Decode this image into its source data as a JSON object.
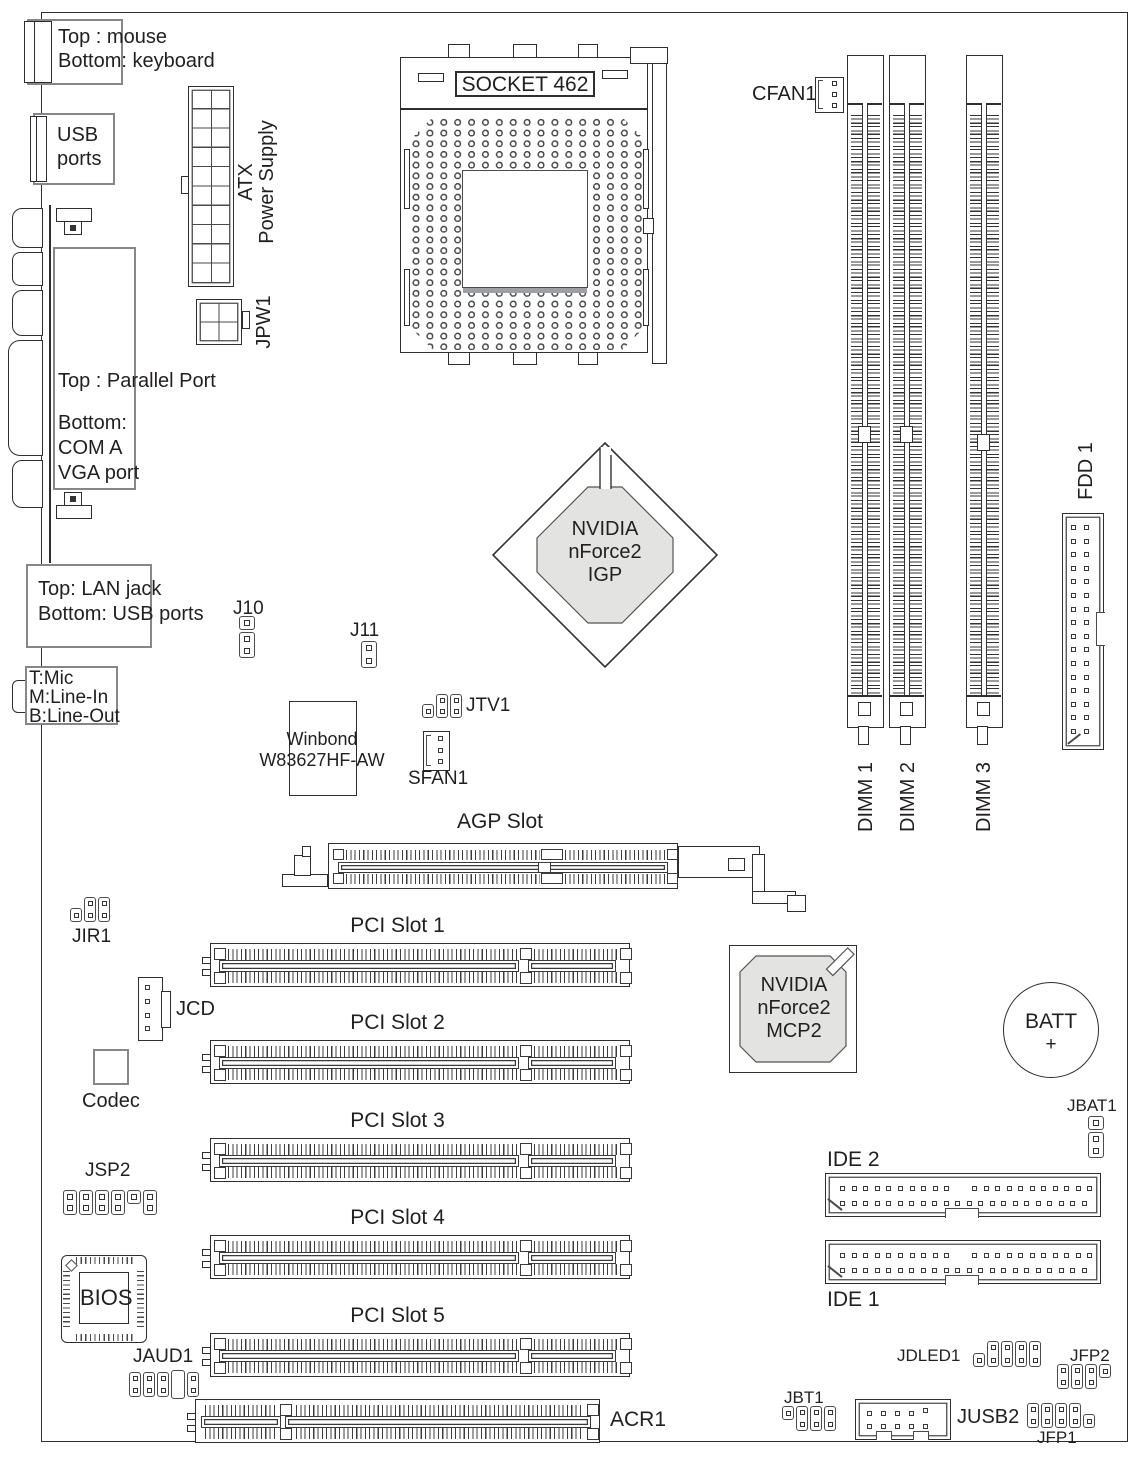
{
  "colors": {
    "line": "#2e2e2e",
    "box_border": "#85878a",
    "chip_fill": "#e3e3e1",
    "text": "#221f20",
    "background": "#ffffff"
  },
  "back_panel": {
    "ps2": {
      "l1": "Top : mouse",
      "l2": "Bottom: keyboard"
    },
    "usb": {
      "l1": "USB",
      "l2": "ports"
    },
    "parallel": {
      "l1": "Top : Parallel Port",
      "l2": "Bottom:",
      "l3": "COM A",
      "l4": "VGA port"
    },
    "lan": {
      "l1": "Top: LAN jack",
      "l2": "Bottom: USB ports"
    },
    "audio": {
      "l1": "T:Mic",
      "l2": "M:Line-In",
      "l3": "B:Line-Out"
    }
  },
  "power": {
    "atx_l1": "ATX",
    "atx_l2": "Power Supply",
    "jpw1": "JPW1"
  },
  "cpu": {
    "socket": "SOCKET 462",
    "cfan1": "CFAN1"
  },
  "memory": {
    "dimm1": "DIMM 1",
    "dimm2": "DIMM 2",
    "dimm3": "DIMM 3"
  },
  "storage": {
    "fdd": "FDD 1",
    "ide1": "IDE 1",
    "ide2": "IDE 2"
  },
  "chipset": {
    "igp_l1": "NVIDIA",
    "igp_l2": "nForce2",
    "igp_l3": "IGP",
    "mcp_l1": "NVIDIA",
    "mcp_l2": "nForce2",
    "mcp_l3": "MCP2"
  },
  "io_chip": {
    "l1": "Winbond",
    "l2": "W83627HF-AW"
  },
  "audio_chip": {
    "codec": "Codec"
  },
  "bios": {
    "label": "BIOS"
  },
  "battery": {
    "l1": "BATT",
    "l2": "+"
  },
  "slots": {
    "agp": "AGP Slot",
    "pci1": "PCI Slot 1",
    "pci2": "PCI Slot 2",
    "pci3": "PCI Slot 3",
    "pci4": "PCI Slot 4",
    "pci5": "PCI Slot 5",
    "acr1": "ACR1"
  },
  "headers": {
    "j10": "J10",
    "j11": "J11",
    "jtv1": "JTV1",
    "sfan1": "SFAN1",
    "jir1": "JIR1",
    "jcd": "JCD",
    "jbat1": "JBAT1",
    "jsp2": "JSP2",
    "jaud1": "JAUD1",
    "jbt1": "JBT1",
    "jusb2": "JUSB2",
    "jdled1": "JDLED1",
    "jfp1": "JFP1",
    "jfp2": "JFP2"
  }
}
